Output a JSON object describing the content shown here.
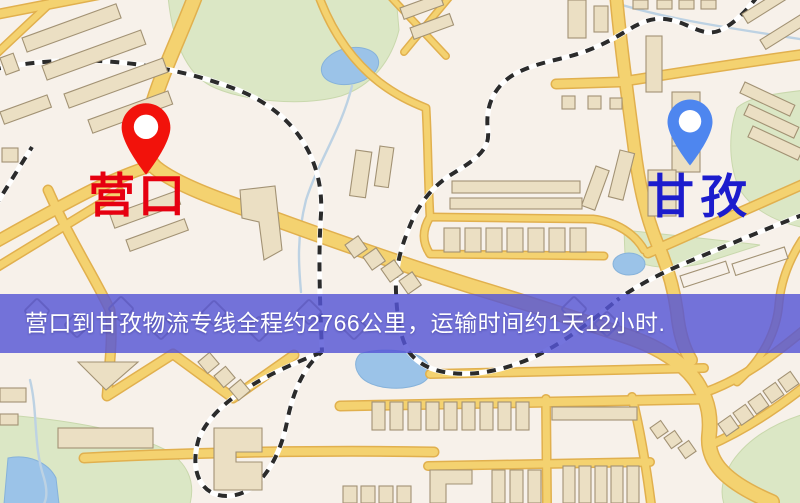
{
  "meta": {
    "width": 800,
    "height": 503,
    "description": "logistics route map screenshot"
  },
  "banner": {
    "text": "营口到甘孜物流专线全程约2766公里，运输时间约1天12小时.",
    "distance_km": "2766",
    "transit_time": "1天12小时"
  },
  "markers": {
    "origin": {
      "label": "营口",
      "icon": "red-teardrop-pin-icon"
    },
    "destination": {
      "label": "甘孜",
      "icon": "blue-teardrop-pin-icon"
    }
  },
  "theme": {
    "map_bg": "#f7f1ea",
    "park": "#dbe7c4",
    "park_edge": "#c9d8ab",
    "water": "#9ac3ea",
    "water_edge": "#84b2dc",
    "stream": "#bcd2e4",
    "road_fill": "#f5d26c",
    "road_edge": "#e3b04a",
    "rail_dark": "#2b2b2b",
    "rail_light": "#ffffff",
    "building_fill": "#ebdfc2",
    "building_edge": "#a39273",
    "banner_bg": "#5656d6",
    "banner_text": "#ffffff",
    "pin_origin": "#f2120b",
    "pin_destination": "#4e86ef",
    "label_origin": "#e60010",
    "label_destination": "#1c1ccd"
  }
}
